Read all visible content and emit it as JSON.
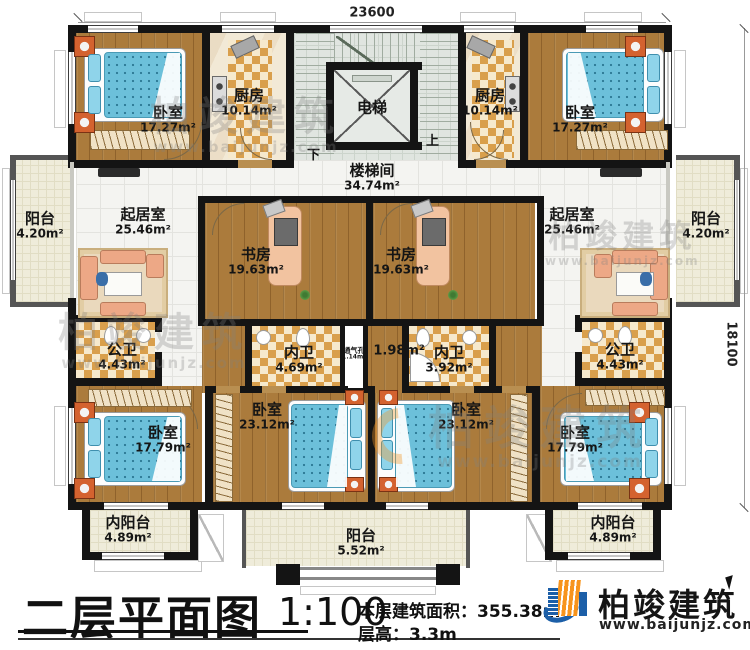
{
  "plan": {
    "dim_width": "23600",
    "dim_height": "18100",
    "elevator": "电梯",
    "stair_up": "上",
    "stair_down": "下",
    "rooms": {
      "stairwell": {
        "label": "楼梯间",
        "area": "34.74m²"
      },
      "bedroom_tl": {
        "label": "卧室",
        "area": "17.27m²"
      },
      "kitchen_l": {
        "label": "厨房",
        "area": "10.14m²"
      },
      "kitchen_r": {
        "label": "厨房",
        "area": "10.14m²"
      },
      "bedroom_tr": {
        "label": "卧室",
        "area": "17.27m²"
      },
      "balcony_l": {
        "label": "阳台",
        "area": "4.20m²"
      },
      "living_l": {
        "label": "起居室",
        "area": "25.46m²"
      },
      "study_l": {
        "label": "书房",
        "area": "19.63m²"
      },
      "study_r": {
        "label": "书房",
        "area": "19.63m²"
      },
      "living_r": {
        "label": "起居室",
        "area": "25.46m²"
      },
      "balcony_r": {
        "label": "阳台",
        "area": "4.20m²"
      },
      "bath_public_l": {
        "label": "公卫",
        "area": "4.43m²"
      },
      "bath_en_l": {
        "label": "内卫",
        "area": "4.69m²"
      },
      "vent": {
        "label": "通气孔",
        "area": "1.14m²"
      },
      "corridor": {
        "area": "1.98m²"
      },
      "bath_en_r": {
        "label": "内卫",
        "area": "3.92m²"
      },
      "bath_public_r": {
        "label": "公卫",
        "area": "4.43m²"
      },
      "bedroom_bl": {
        "label": "卧室",
        "area": "17.79m²"
      },
      "bedroom_bcl": {
        "label": "卧室",
        "area": "23.12m²"
      },
      "bedroom_bcr": {
        "label": "卧室",
        "area": "23.12m²"
      },
      "bedroom_br": {
        "label": "卧室",
        "area": "17.79m²"
      },
      "inner_balcony_l": {
        "label": "内阳台",
        "area": "4.89m²"
      },
      "balcony_b": {
        "label": "阳台",
        "area": "5.52m²"
      },
      "inner_balcony_r": {
        "label": "内阳台",
        "area": "4.89m²"
      }
    }
  },
  "title_block": {
    "title": "二层平面图",
    "scale": "1:100",
    "floor_area_label": "本层建筑面积：",
    "floor_area_value": "355.38m²",
    "floor_height_label": "层高：",
    "floor_height_value": "3.3m"
  },
  "branding": {
    "company": "柏竣建筑",
    "website": "www.baijunjz.com"
  },
  "watermark": {
    "company": "柏竣建筑",
    "website": "www.baijunjz.com"
  },
  "colors": {
    "wall": "#141414",
    "wood_floor": "#ab7b3c",
    "tile_accent": "#d99f4c",
    "white_tile": "#f4f4f1",
    "bed_blue": "#6cc0da",
    "sofa_peach": "#eda886",
    "logo_blue": "#1c5fa8",
    "logo_orange": "#f7941d"
  }
}
